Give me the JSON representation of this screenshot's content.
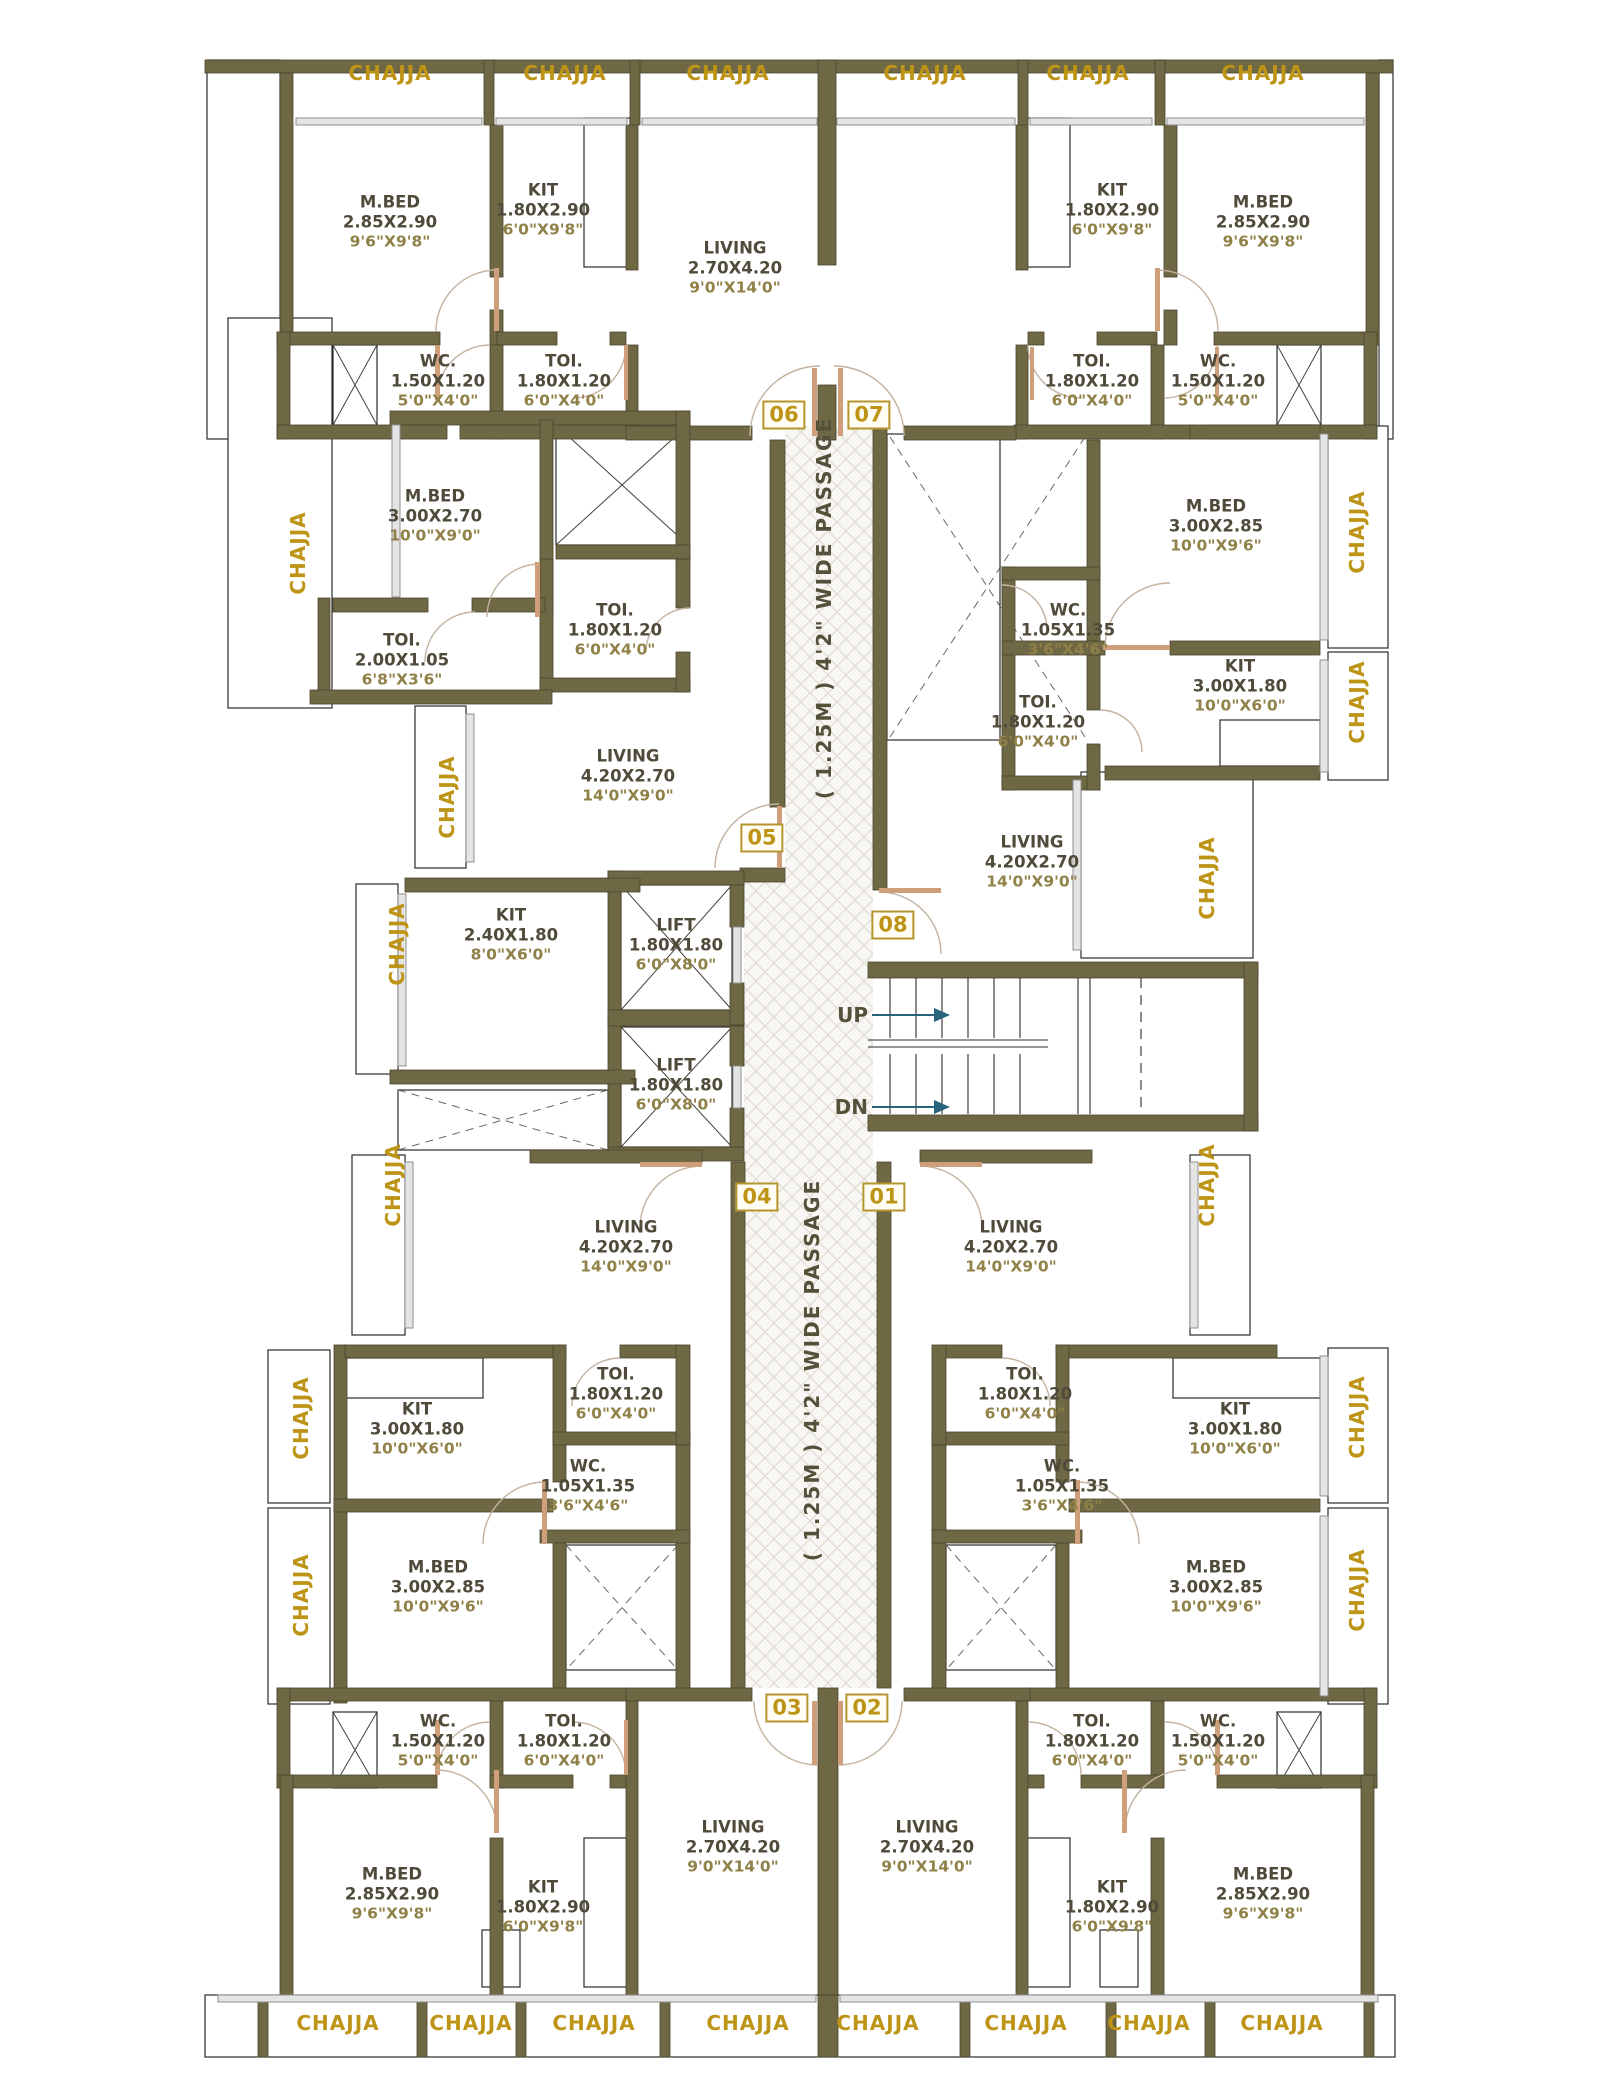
{
  "title": "Typical Floor Plan",
  "colors": {
    "wall": "#6e6845",
    "gold": "#bd9415",
    "gold_border": "#b5952c",
    "room_text": "#4f4a3a",
    "dim_text": "#8f8147",
    "arrow": "#27637a"
  },
  "labels": {
    "chajja": "CHAJJA",
    "passage": "( 1.25M ) 4'2\" WIDE PASSAGE",
    "up": "UP",
    "dn": "DN"
  },
  "units": [
    "06",
    "07",
    "05",
    "08",
    "04",
    "01",
    "03",
    "02"
  ],
  "rooms": [
    {
      "name": "M.BED",
      "dim_m": "2.85X2.90",
      "dim_ft": "9'6\"X9'8\""
    },
    {
      "name": "KIT",
      "dim_m": "1.80X2.90",
      "dim_ft": "6'0\"X9'8\""
    },
    {
      "name": "LIVING",
      "dim_m": "2.70X4.20",
      "dim_ft": "9'0\"X14'0\""
    },
    {
      "name": "WC.",
      "dim_m": "1.50X1.20",
      "dim_ft": "5'0\"X4'0\""
    },
    {
      "name": "TOI.",
      "dim_m": "1.80X1.20",
      "dim_ft": "6'0\"X4'0\""
    },
    {
      "name": "KIT",
      "dim_m": "1.80X2.90",
      "dim_ft": "6'0\"X9'8\""
    },
    {
      "name": "M.BED",
      "dim_m": "2.85X2.90",
      "dim_ft": "9'6\"X9'8\""
    },
    {
      "name": "TOI.",
      "dim_m": "1.80X1.20",
      "dim_ft": "6'0\"X4'0\""
    },
    {
      "name": "WC.",
      "dim_m": "1.50X1.20",
      "dim_ft": "5'0\"X4'0\""
    },
    {
      "name": "M.BED",
      "dim_m": "3.00X2.70",
      "dim_ft": "10'0\"X9'0\""
    },
    {
      "name": "TOI.",
      "dim_m": "2.00X1.05",
      "dim_ft": "6'8\"X3'6\""
    },
    {
      "name": "TOI.",
      "dim_m": "1.80X1.20",
      "dim_ft": "6'0\"X4'0\""
    },
    {
      "name": "LIVING",
      "dim_m": "4.20X2.70",
      "dim_ft": "14'0\"X9'0\""
    },
    {
      "name": "KIT",
      "dim_m": "2.40X1.80",
      "dim_ft": "8'0\"X6'0\""
    },
    {
      "name": "LIFT",
      "dim_m": "1.80X1.80",
      "dim_ft": "6'0\"X8'0\""
    },
    {
      "name": "LIFT",
      "dim_m": "1.80X1.80",
      "dim_ft": "6'0\"X8'0\""
    },
    {
      "name": "M.BED",
      "dim_m": "3.00X2.85",
      "dim_ft": "10'0\"X9'6\""
    },
    {
      "name": "WC.",
      "dim_m": "1.05X1.35",
      "dim_ft": "3'6\"X4'6\""
    },
    {
      "name": "TOI.",
      "dim_m": "1.80X1.20",
      "dim_ft": "6'0\"X4'0\""
    },
    {
      "name": "KIT",
      "dim_m": "3.00X1.80",
      "dim_ft": "10'0\"X6'0\""
    },
    {
      "name": "LIVING",
      "dim_m": "4.20X2.70",
      "dim_ft": "14'0\"X9'0\""
    },
    {
      "name": "LIVING",
      "dim_m": "4.20X2.70",
      "dim_ft": "14'0\"X9'0\""
    },
    {
      "name": "KIT",
      "dim_m": "3.00X1.80",
      "dim_ft": "10'0\"X6'0\""
    },
    {
      "name": "TOI.",
      "dim_m": "1.80X1.20",
      "dim_ft": "6'0\"X4'0\""
    },
    {
      "name": "WC.",
      "dim_m": "1.05X1.35",
      "dim_ft": "3'6\"X4'6\""
    },
    {
      "name": "M.BED",
      "dim_m": "3.00X2.85",
      "dim_ft": "10'0\"X9'6\""
    },
    {
      "name": "LIVING",
      "dim_m": "4.20X2.70",
      "dim_ft": "14'0\"X9'0\""
    },
    {
      "name": "TOI.",
      "dim_m": "1.80X1.20",
      "dim_ft": "6'0\"X4'0\""
    },
    {
      "name": "WC.",
      "dim_m": "1.05X1.35",
      "dim_ft": "3'6\"X4'6\""
    },
    {
      "name": "KIT",
      "dim_m": "3.00X1.80",
      "dim_ft": "10'0\"X6'0\""
    },
    {
      "name": "M.BED",
      "dim_m": "3.00X2.85",
      "dim_ft": "10'0\"X9'6\""
    },
    {
      "name": "WC.",
      "dim_m": "1.50X1.20",
      "dim_ft": "5'0\"X4'0\""
    },
    {
      "name": "TOI.",
      "dim_m": "1.80X1.20",
      "dim_ft": "6'0\"X4'0\""
    },
    {
      "name": "M.BED",
      "dim_m": "2.85X2.90",
      "dim_ft": "9'6\"X9'8\""
    },
    {
      "name": "KIT",
      "dim_m": "1.80X2.90",
      "dim_ft": "6'0\"X9'8\""
    },
    {
      "name": "LIVING",
      "dim_m": "2.70X4.20",
      "dim_ft": "9'0\"X14'0\""
    },
    {
      "name": "LIVING",
      "dim_m": "2.70X4.20",
      "dim_ft": "9'0\"X14'0\""
    },
    {
      "name": "TOI.",
      "dim_m": "1.80X1.20",
      "dim_ft": "6'0\"X4'0\""
    },
    {
      "name": "WC.",
      "dim_m": "1.50X1.20",
      "dim_ft": "5'0\"X4'0\""
    },
    {
      "name": "KIT",
      "dim_m": "1.80X2.90",
      "dim_ft": "6'0\"X9'8\""
    },
    {
      "name": "M.BED",
      "dim_m": "2.85X2.90",
      "dim_ft": "9'6\"X9'8\""
    }
  ]
}
